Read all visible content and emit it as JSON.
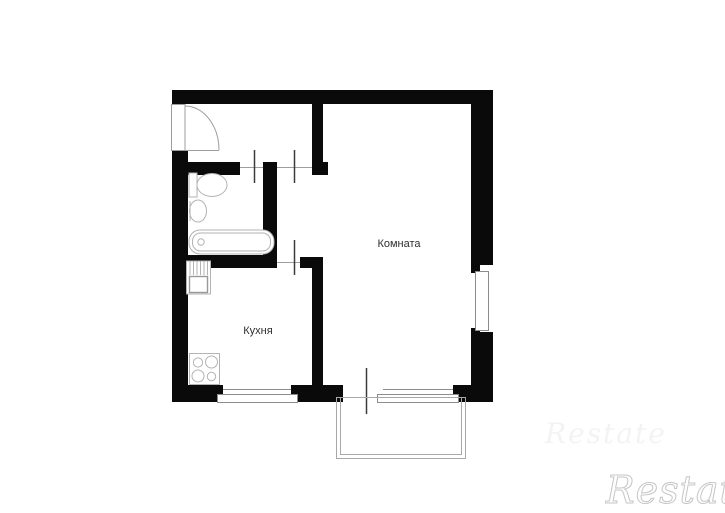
{
  "floor_plan": {
    "labels": {
      "room": "Комната",
      "kitchen": "Кухня"
    },
    "colors": {
      "wall": "#0a0a0a",
      "fixture_line": "#b3b3b3",
      "door_line": "#9e9e9e",
      "door_leaf_tick": "#3c3c3c",
      "label_text": "#2f2f2f",
      "watermark_outline": "#c6c6c6",
      "background": "#ffffff"
    },
    "fixtures": [
      "entrance-door",
      "toilet",
      "washbasin",
      "bathtub",
      "kitchen-sink",
      "stove"
    ],
    "openings": [
      "entrance-door",
      "bathroom-door",
      "room-door",
      "kitchen-door",
      "balcony-door"
    ],
    "windows": [
      "side-window",
      "kitchen-window",
      "room-window"
    ],
    "balcony": "balcony-outline"
  },
  "watermark": {
    "text": "Restate",
    "faint_text": "Restate"
  }
}
